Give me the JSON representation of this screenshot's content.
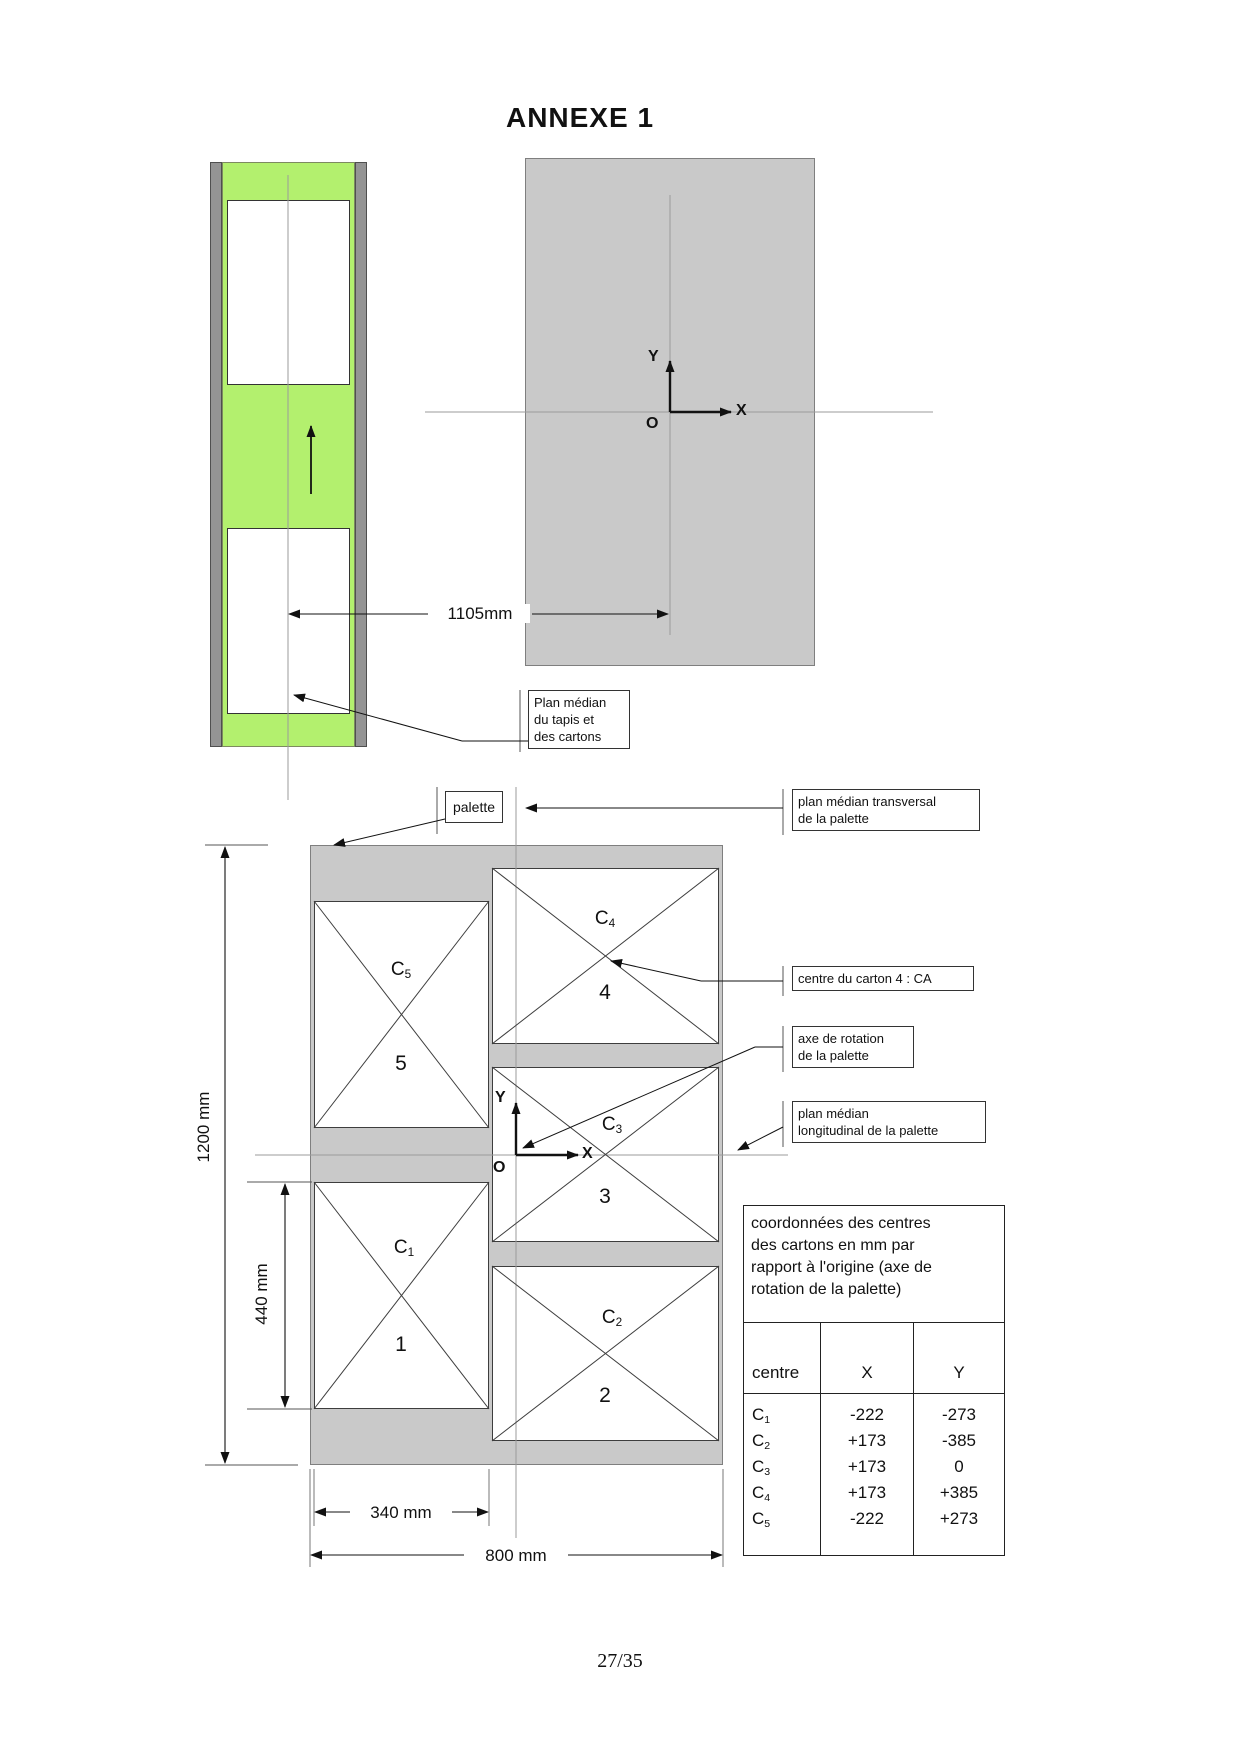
{
  "page": {
    "title": "ANNEXE 1",
    "page_number": "27/35"
  },
  "axes": {
    "x": "X",
    "y": "Y",
    "origin": "O"
  },
  "top_diagram": {
    "dim_1105": "1105mm",
    "plan_median_tapis_lines": [
      "Plan médian",
      "du tapis et",
      "des cartons"
    ]
  },
  "pallet_diagram": {
    "palette_label": "palette",
    "plan_transversal_lines": [
      "plan médian transversal",
      "de la palette"
    ],
    "centre_carton4_label": "centre du carton 4 : CA",
    "axe_rotation_lines": [
      "axe de rotation",
      "de la palette"
    ],
    "plan_longitudinal_lines": [
      "plan médian",
      "longitudinal de la palette"
    ],
    "dims": {
      "height": "1200 mm",
      "carton_height": "440 mm",
      "carton_width": "340 mm",
      "width": "800 mm"
    },
    "cartons": [
      {
        "base": "C",
        "sub": "5",
        "number": "5"
      },
      {
        "base": "C",
        "sub": "4",
        "number": "4"
      },
      {
        "base": "C",
        "sub": "3",
        "number": "3"
      },
      {
        "base": "C",
        "sub": "1",
        "number": "1"
      },
      {
        "base": "C",
        "sub": "2",
        "number": "2"
      }
    ]
  },
  "coords_table": {
    "title_lines": [
      "coordonnées des centres",
      "des cartons en mm par",
      "rapport à l'origine (axe de",
      "rotation de la palette)"
    ],
    "headers": {
      "centre": "centre",
      "x": "X",
      "y": "Y"
    },
    "rows": [
      {
        "base": "C",
        "sub": "1",
        "x": "-222",
        "y": "-273"
      },
      {
        "base": "C",
        "sub": "2",
        "x": "+173",
        "y": "-385"
      },
      {
        "base": "C",
        "sub": "3",
        "x": "+173",
        "y": "0"
      },
      {
        "base": "C",
        "sub": "4",
        "x": "+173",
        "y": "+385"
      },
      {
        "base": "C",
        "sub": "5",
        "x": "-222",
        "y": "+273"
      }
    ]
  },
  "colors": {
    "belt_green": "#b3f06e",
    "pallet_gray": "#c9c9c9",
    "rail_gray": "#949494"
  }
}
